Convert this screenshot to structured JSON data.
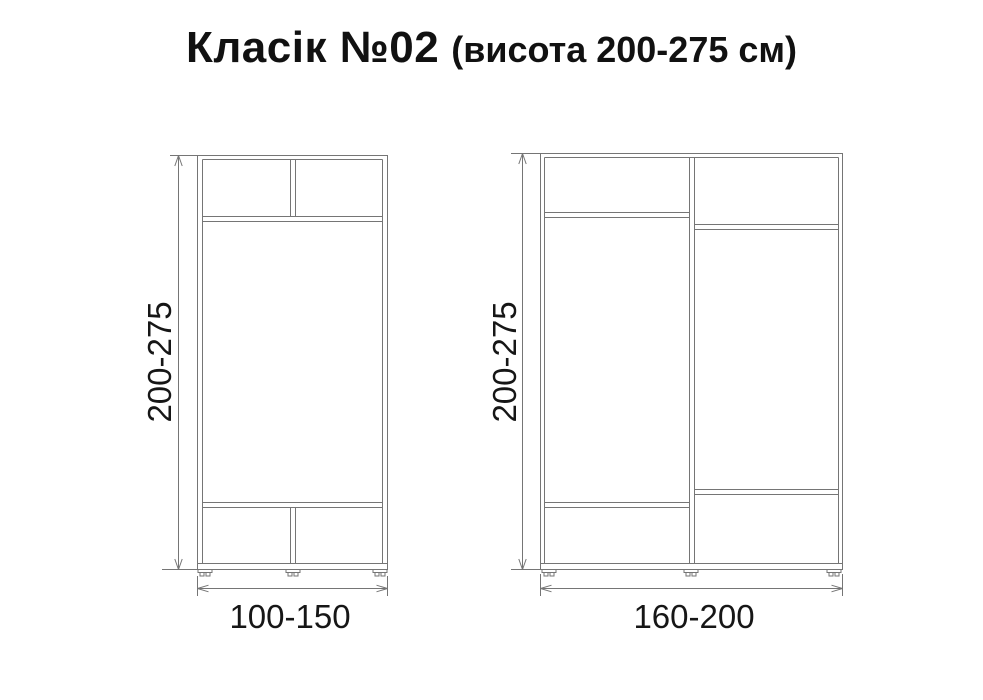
{
  "title": {
    "main": "Класік №02",
    "sub": "(висота 200-275 см)"
  },
  "dimensions": {
    "left_wardrobe": {
      "height": "200-275",
      "width": "100-150"
    },
    "right_wardrobe": {
      "height": "200-275",
      "width": "160-200"
    }
  },
  "colors": {
    "line": "#757575",
    "text": "#161616",
    "background": "#ffffff"
  }
}
